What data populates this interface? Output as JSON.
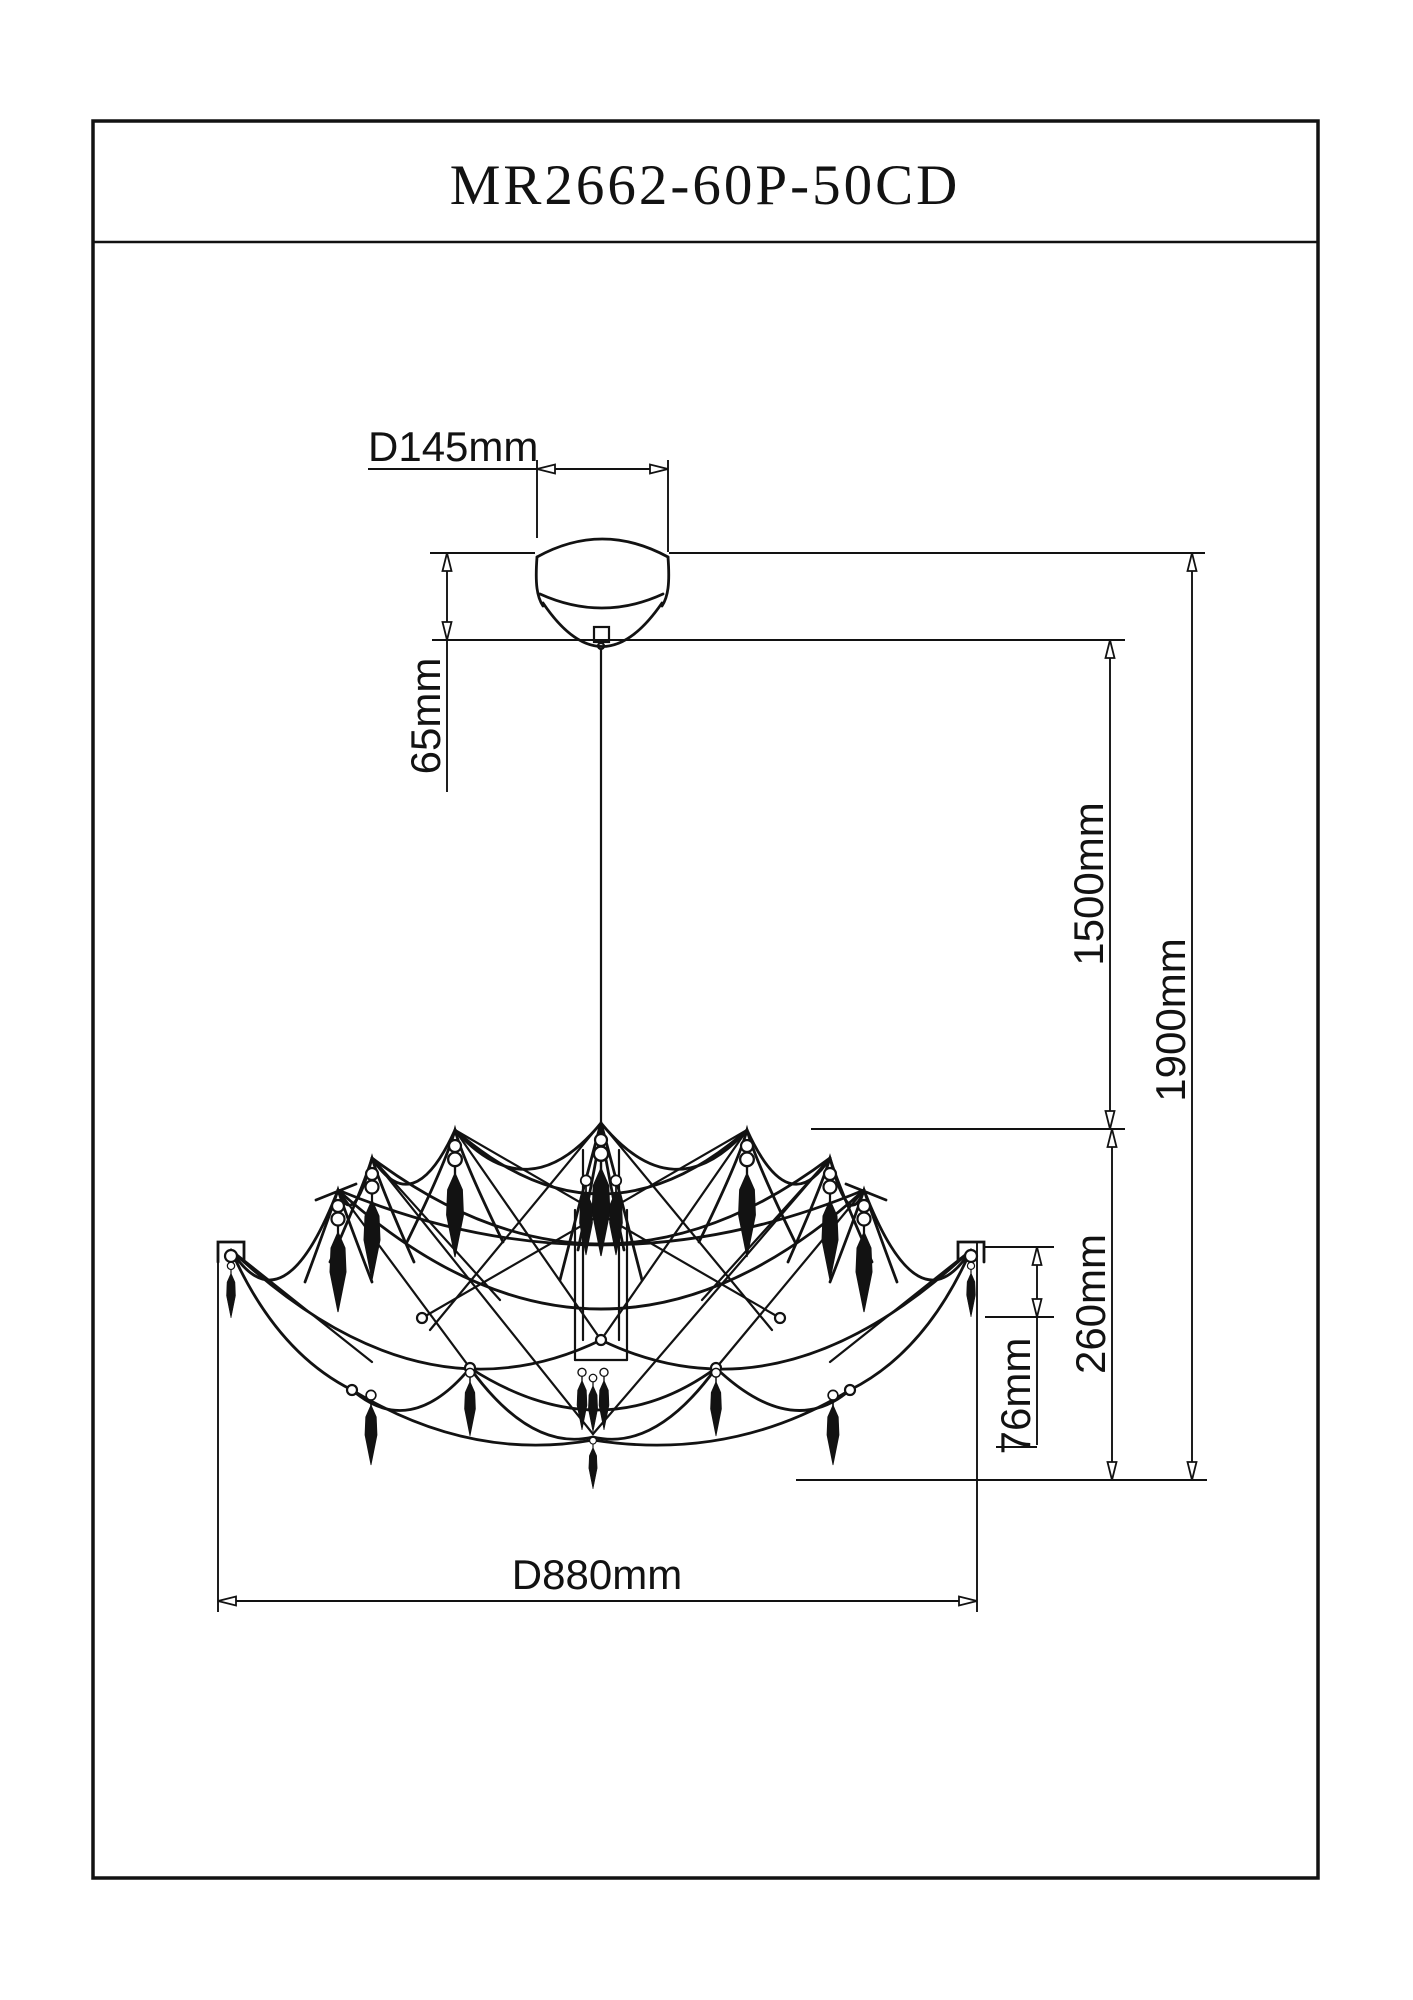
{
  "page": {
    "title": "MR2662-60P-50CD"
  },
  "dimensions": {
    "canopy_diameter": "D145mm",
    "canopy_height": "65mm",
    "cord_length": "1500mm",
    "total_height": "1900mm",
    "body_height": "260mm",
    "crystal_length": "76mm",
    "fixture_diameter": "D880mm"
  },
  "drawing": {
    "ink_color": "#121212",
    "background_color": "#ffffff",
    "subject": "pendant chandelier dimensional drawing"
  }
}
